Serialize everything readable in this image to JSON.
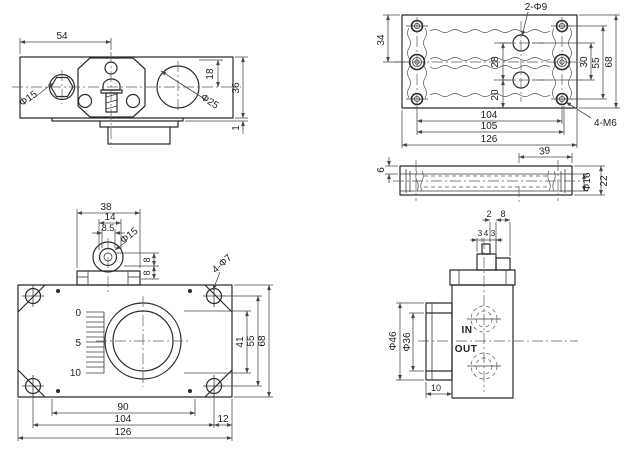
{
  "title": "valve-technical-drawing",
  "colors": {
    "background": "#ffffff",
    "line": "#2b2b2b",
    "dim": "#474747"
  },
  "views": {
    "front_top": {
      "name": "front view top-left",
      "dims": {
        "width_54": "54",
        "height_18": "18",
        "height_36": "36",
        "step_1": "1",
        "plug_dia": "Φ15",
        "bore_dia": "Φ25"
      }
    },
    "plan": {
      "name": "plan view top-right",
      "dims": {
        "holes_label": "2-Φ9",
        "v34": "34",
        "v28": "28",
        "v20": "20",
        "v30": "30",
        "v55": "55",
        "v68": "68",
        "w104": "104",
        "w105": "105",
        "w126": "126",
        "thread_label": "4-M6"
      }
    },
    "side_bar": {
      "name": "side section middle-right",
      "dims": {
        "w39": "39",
        "bore_dia": "Φ16",
        "h22": "22",
        "t6": "6"
      }
    },
    "front_main": {
      "name": "front view bottom-left",
      "dims": {
        "w38": "38",
        "w14": "14",
        "w8_5": "8.5",
        "knob_dia": "Φ15",
        "h8_top": "8",
        "h8_bottom": "8",
        "holes_label": "4-Φ7",
        "v41": "41",
        "v55": "55",
        "v68": "68",
        "w90": "90",
        "w104": "104",
        "w12": "12",
        "w126": "126"
      },
      "scale_marks": [
        "0",
        "5",
        "10"
      ]
    },
    "side_main": {
      "name": "side view bottom-right",
      "dims": {
        "w2": "2",
        "w8": "8",
        "w3a": "3",
        "w4": "4",
        "w3b": "3",
        "outer_dia": "Φ46",
        "inner_dia": "Φ36",
        "w10": "10"
      },
      "ports": {
        "in": "IN",
        "out": "OUT"
      }
    }
  }
}
